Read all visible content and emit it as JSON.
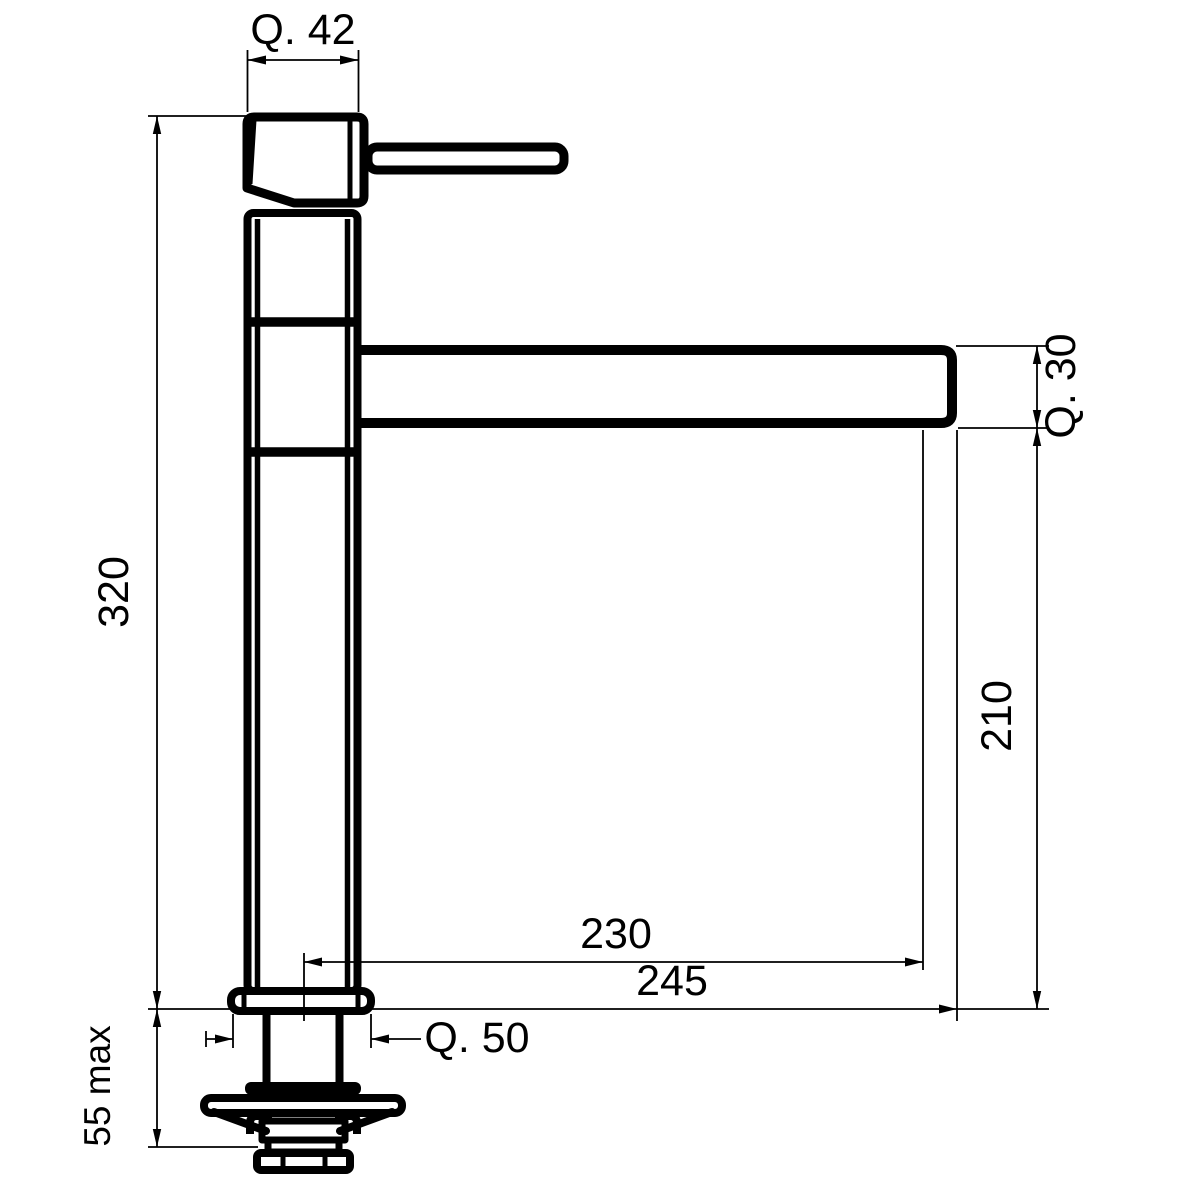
{
  "drawing": {
    "kind": "technical dimension drawing",
    "subject": "single-lever tall kitchen mixer tap, side elevation",
    "colors": {
      "line": "#000000",
      "background": "#ffffff"
    },
    "labels": {
      "head_width": "Q. 42",
      "overall_height": "320",
      "spout_section": "Q. 30",
      "spout_underside_height": "210",
      "reach_to_outlet": "230",
      "reach_overall": "245",
      "base_width": "Q. 50",
      "deck_thickness_max": "55 max"
    }
  }
}
